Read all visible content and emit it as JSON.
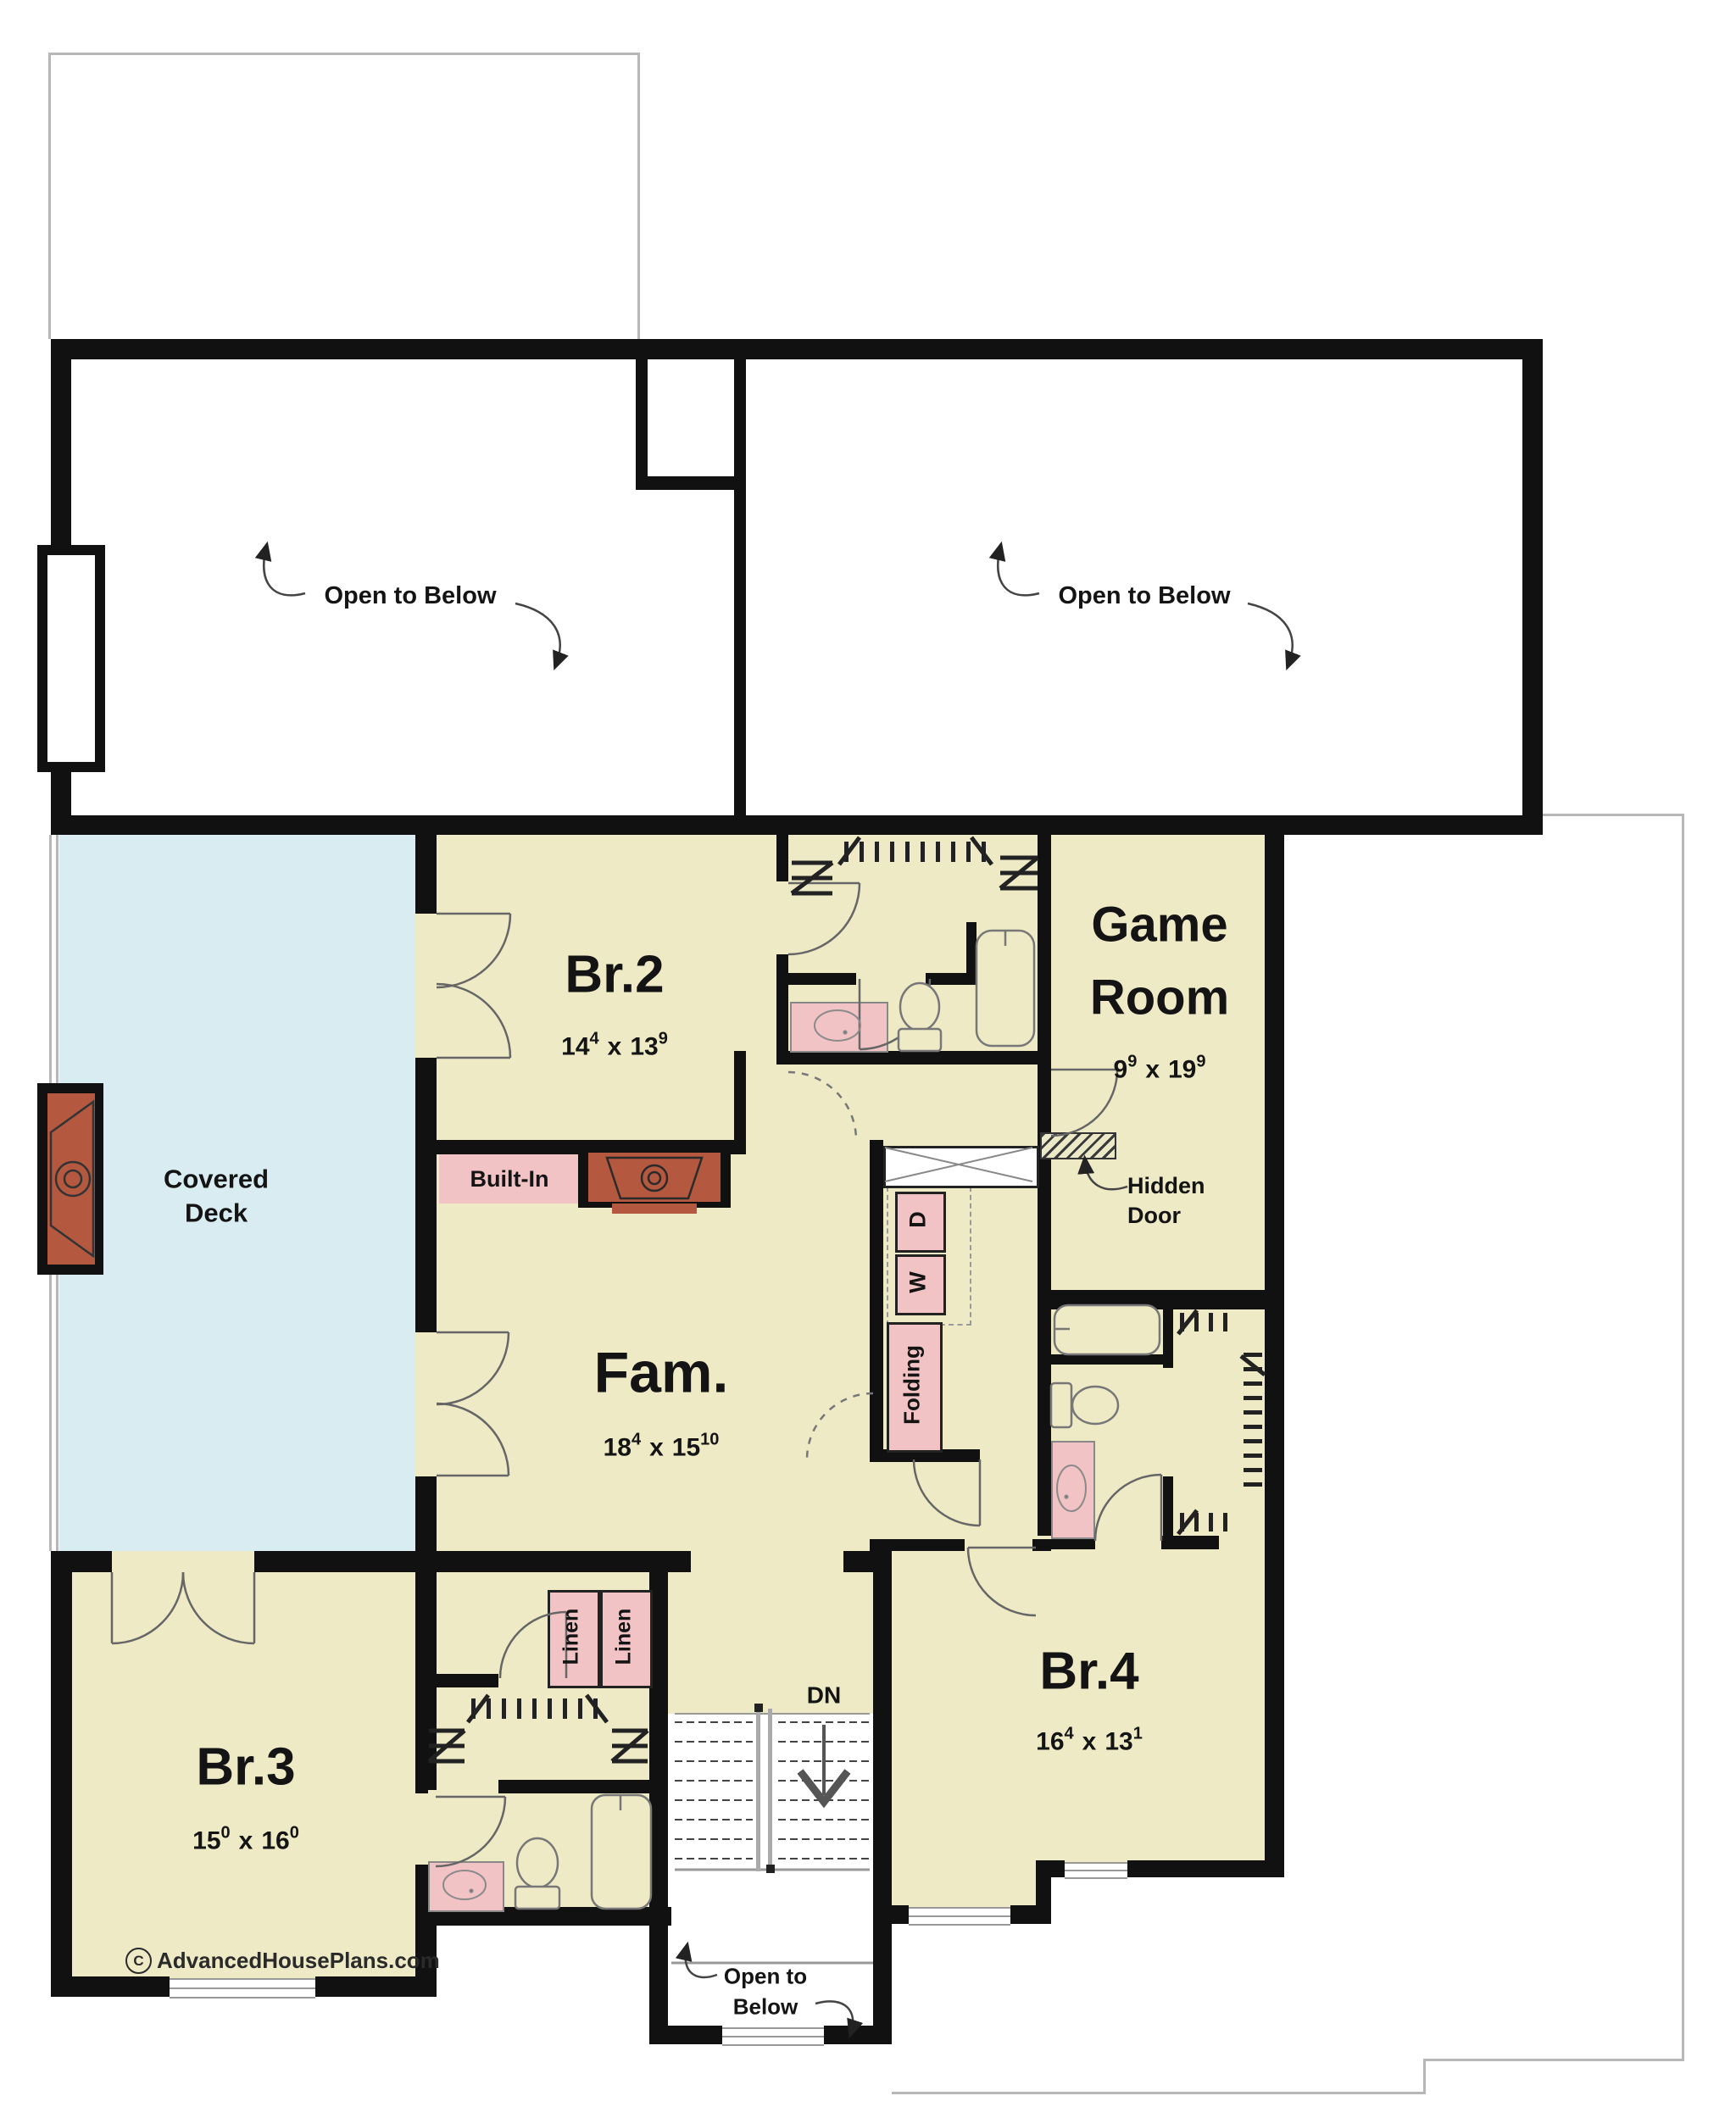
{
  "plan": {
    "watermark": {
      "symbol": "C",
      "text": "AdvancedHousePlans.com"
    },
    "colors": {
      "room_fill": "#eeeac6",
      "deck_fill": "#d9ecf1",
      "fixture_pink": "#f2c3c5",
      "accent_terracotta": "#b4593f",
      "wall_black": "#111111",
      "roof_outline_gray": "#b7b7b7"
    },
    "rooms": {
      "open_left": {
        "label": "Open to Below"
      },
      "open_right": {
        "label": "Open to Below"
      },
      "deck": {
        "line1": "Covered",
        "line2": "Deck"
      },
      "br2": {
        "name": "Br.2",
        "dim_a": "14",
        "dim_a_sup": "4",
        "dim_sep": "x",
        "dim_b": "13",
        "dim_b_sup": "9"
      },
      "game": {
        "line1": "Game",
        "line2": "Room",
        "dim_a": "9",
        "dim_a_sup": "9",
        "dim_sep": "x",
        "dim_b": "19",
        "dim_b_sup": "9"
      },
      "fam": {
        "name": "Fam.",
        "dim_a": "18",
        "dim_a_sup": "4",
        "dim_sep": "x",
        "dim_b": "15",
        "dim_b_sup": "10"
      },
      "br3": {
        "name": "Br.3",
        "dim_a": "15",
        "dim_a_sup": "0",
        "dim_sep": "x",
        "dim_b": "16",
        "dim_b_sup": "0"
      },
      "br4": {
        "name": "Br.4",
        "dim_a": "16",
        "dim_a_sup": "4",
        "dim_sep": "x",
        "dim_b": "13",
        "dim_b_sup": "1"
      },
      "stair_open": {
        "line1": "Open to",
        "line2": "Below"
      }
    },
    "features": {
      "built_in": "Built-In",
      "hidden_door_line1": "Hidden",
      "hidden_door_line2": "Door",
      "folding": "Folding",
      "washer": "W",
      "dryer": "D",
      "linen1": "Linen",
      "linen2": "Linen",
      "down": "DN"
    }
  }
}
